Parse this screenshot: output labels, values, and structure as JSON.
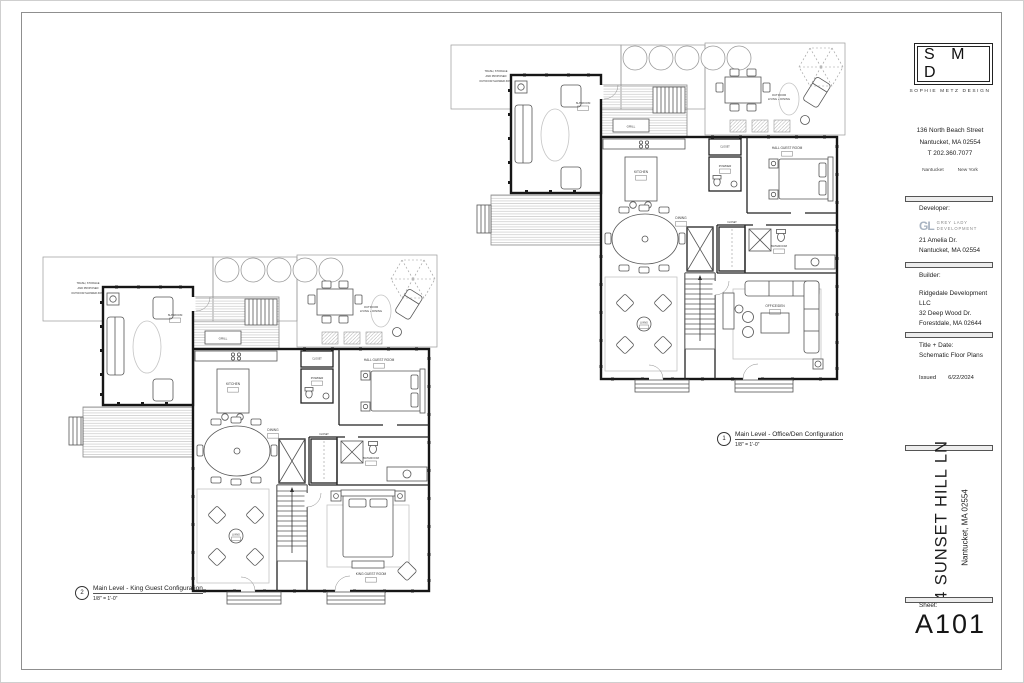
{
  "firm": {
    "logo_text": "S M D",
    "name": "SOPHIE METZ DESIGN",
    "address_lines": [
      "136 North Beach Street",
      "Nantucket, MA 02554",
      "T 202.360.7077"
    ],
    "offices": [
      "Nantucket",
      "New York"
    ]
  },
  "developer": {
    "heading": "Developer:",
    "logo_initials": "GL",
    "logo_name_lines": [
      "GREY LADY",
      "DEVELOPMENT"
    ],
    "address_lines": [
      "21 Amelia Dr.",
      "Nantucket, MA 02554"
    ]
  },
  "builder": {
    "heading": "Builder:",
    "lines": [
      "Ridgedale Development LLC",
      "32 Deep Wood Dr.",
      "Forestdale, MA 02644"
    ]
  },
  "title_block": {
    "heading": "Title + Date:",
    "title": "Schematic Floor Plans",
    "issued_label": "Issued",
    "issued_date": "6/22/2024"
  },
  "project": {
    "name": "4 SUNSET HILL LN",
    "location": "Nantucket, MA 02554"
  },
  "sheet": {
    "label": "Sheet:",
    "number": "A101"
  },
  "plans": {
    "plan1": {
      "number": "1",
      "caption": "Main Level - Office/Den Configuration",
      "scale": "1/8\" = 1'-0\"",
      "labels": {
        "note1": "TRASH, STORAGE",
        "note2": "AND PROPOSED",
        "note3": "OUTDOOR SHOWER ZONE",
        "outdoor1": "OUTDOOR",
        "outdoor2": "LIVING + DINING",
        "grill": "GRILL",
        "sunroom": "SUNROOM",
        "kitchen": "KITCHEN",
        "powder": "POWDER",
        "closet": "CLOSET",
        "dining": "DINING",
        "hall_guest": "HALL GUEST ROOM",
        "bathroom": "BATHROOM",
        "living": "LIVING",
        "feature": "OFFICE/DEN"
      }
    },
    "plan2": {
      "number": "2",
      "caption": "Main Level - King Guest Configuration",
      "scale": "1/8\" = 1'-0\"",
      "labels": {
        "note1": "TRASH, STORAGE",
        "note2": "AND PROPOSED",
        "note3": "OUTDOOR SHOWER ZONE",
        "outdoor1": "OUTDOOR",
        "outdoor2": "LIVING + DINING",
        "grill": "GRILL",
        "sunroom": "SUNROOM",
        "kitchen": "KITCHEN",
        "powder": "POWDER",
        "closet": "CLOSET",
        "dining": "DINING",
        "hall_guest": "HALL GUEST ROOM",
        "bathroom": "BATHROOM",
        "living": "LIVING",
        "feature": "KING GUEST ROOM"
      }
    }
  },
  "colors": {
    "wall": "#161616",
    "line": "#555555",
    "frame": "#8f8f8f"
  }
}
